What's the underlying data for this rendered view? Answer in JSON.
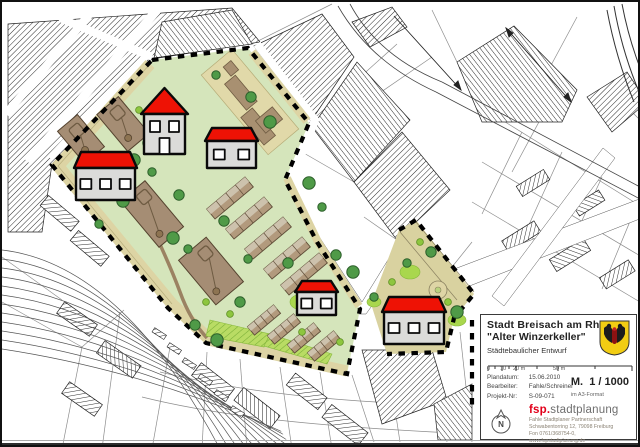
{
  "title_block": {
    "city": "Stadt Breisach am Rhein",
    "project": "\"Alter Winzerkeller\"",
    "subtitle": "Städtebaulicher Entwurf",
    "plandatum_label": "Plandatum:",
    "plandatum": "15.06.2010",
    "bearbeiter_label": "Bearbeiter:",
    "bearbeiter": "Fahle/Schreiner",
    "projekt_label": "Projekt-Nr:",
    "projekt": "S-09-071",
    "scale_m": "M.",
    "scale_value": "1 / 1000",
    "scale_note": "im A3-Format",
    "scale_ticks": [
      "0",
      "10",
      "20 m",
      "50 m"
    ],
    "logo_prefix": "fsp.",
    "logo_suffix": "stadtplanung",
    "address_lines": [
      "Fahle Stadtplaner Partnerschaft",
      "Schwabentorring 12, 79098 Freiburg",
      "Fon 0761/368754-0, www.fspstadtplanung.de"
    ],
    "north_label": "N",
    "colors": {
      "logo_red": "#e2001a",
      "crest_yellow": "#f2cd13"
    }
  },
  "map": {
    "colors": {
      "roof_red": "#ee1205",
      "wall_grey": "#dbdbd9",
      "site_green": "#d5e5bb",
      "path_tan": "#ddd4a4",
      "tree_green": "#4f9a47",
      "bush_green": "#8ec63f",
      "block_brown": "#a58d74"
    },
    "houses": [
      {
        "name": "house-gable-north",
        "type": "gable",
        "x": 139,
        "y": 86,
        "w": 47,
        "h": 66,
        "windows": 2
      },
      {
        "name": "house-west",
        "type": "wide",
        "x": 72,
        "y": 150,
        "w": 63,
        "h": 48,
        "roof": 16,
        "windows": 3
      },
      {
        "name": "house-center",
        "type": "wide",
        "x": 203,
        "y": 126,
        "w": 53,
        "h": 40,
        "roof": 13,
        "windows": 2
      },
      {
        "name": "house-south",
        "type": "wide",
        "x": 293,
        "y": 279,
        "w": 43,
        "h": 34,
        "roof": 11,
        "windows": 2
      },
      {
        "name": "house-southeast",
        "type": "wide",
        "x": 380,
        "y": 295,
        "w": 64,
        "h": 47,
        "roof": 15,
        "windows": 3
      }
    ],
    "trees": [
      [
        214,
        73
      ],
      [
        249,
        95
      ],
      [
        268,
        120
      ],
      [
        160,
        120
      ],
      [
        146,
        141
      ],
      [
        132,
        158
      ],
      [
        186,
        247
      ],
      [
        222,
        219
      ],
      [
        171,
        236
      ],
      [
        150,
        170
      ],
      [
        177,
        193
      ],
      [
        121,
        199
      ],
      [
        97,
        222
      ],
      [
        193,
        323
      ],
      [
        215,
        338
      ],
      [
        246,
        257
      ],
      [
        286,
        261
      ],
      [
        307,
        181
      ],
      [
        320,
        205
      ],
      [
        334,
        253
      ],
      [
        351,
        270
      ],
      [
        405,
        261
      ],
      [
        429,
        250
      ],
      [
        455,
        310
      ],
      [
        372,
        295
      ],
      [
        238,
        300
      ]
    ],
    "bushes": [
      [
        137,
        108
      ],
      [
        154,
        127
      ],
      [
        170,
        146
      ],
      [
        204,
        300
      ],
      [
        228,
        312
      ],
      [
        300,
        330
      ],
      [
        338,
        340
      ],
      [
        390,
        280
      ],
      [
        418,
        240
      ],
      [
        446,
        300
      ]
    ],
    "blocks": [
      [
        121,
        122,
        48,
        28
      ],
      [
        79,
        137,
        42,
        26
      ],
      [
        150,
        212,
        60,
        32
      ],
      [
        209,
        269,
        58,
        36
      ]
    ],
    "keller_blocks": [
      [
        -30,
        -6,
        34,
        14
      ],
      [
        6,
        2,
        36,
        15
      ],
      [
        18,
        -14,
        16,
        22
      ],
      [
        -44,
        -12,
        12,
        10
      ]
    ],
    "row_strips": {
      "ne": [
        [
          228,
          196
        ],
        [
          247,
          216
        ],
        [
          266,
          236
        ],
        [
          285,
          256
        ],
        [
          302,
          272
        ]
      ],
      "south": [
        [
          262,
          318
        ],
        [
          282,
          327
        ],
        [
          302,
          336
        ],
        [
          322,
          344
        ]
      ]
    }
  }
}
